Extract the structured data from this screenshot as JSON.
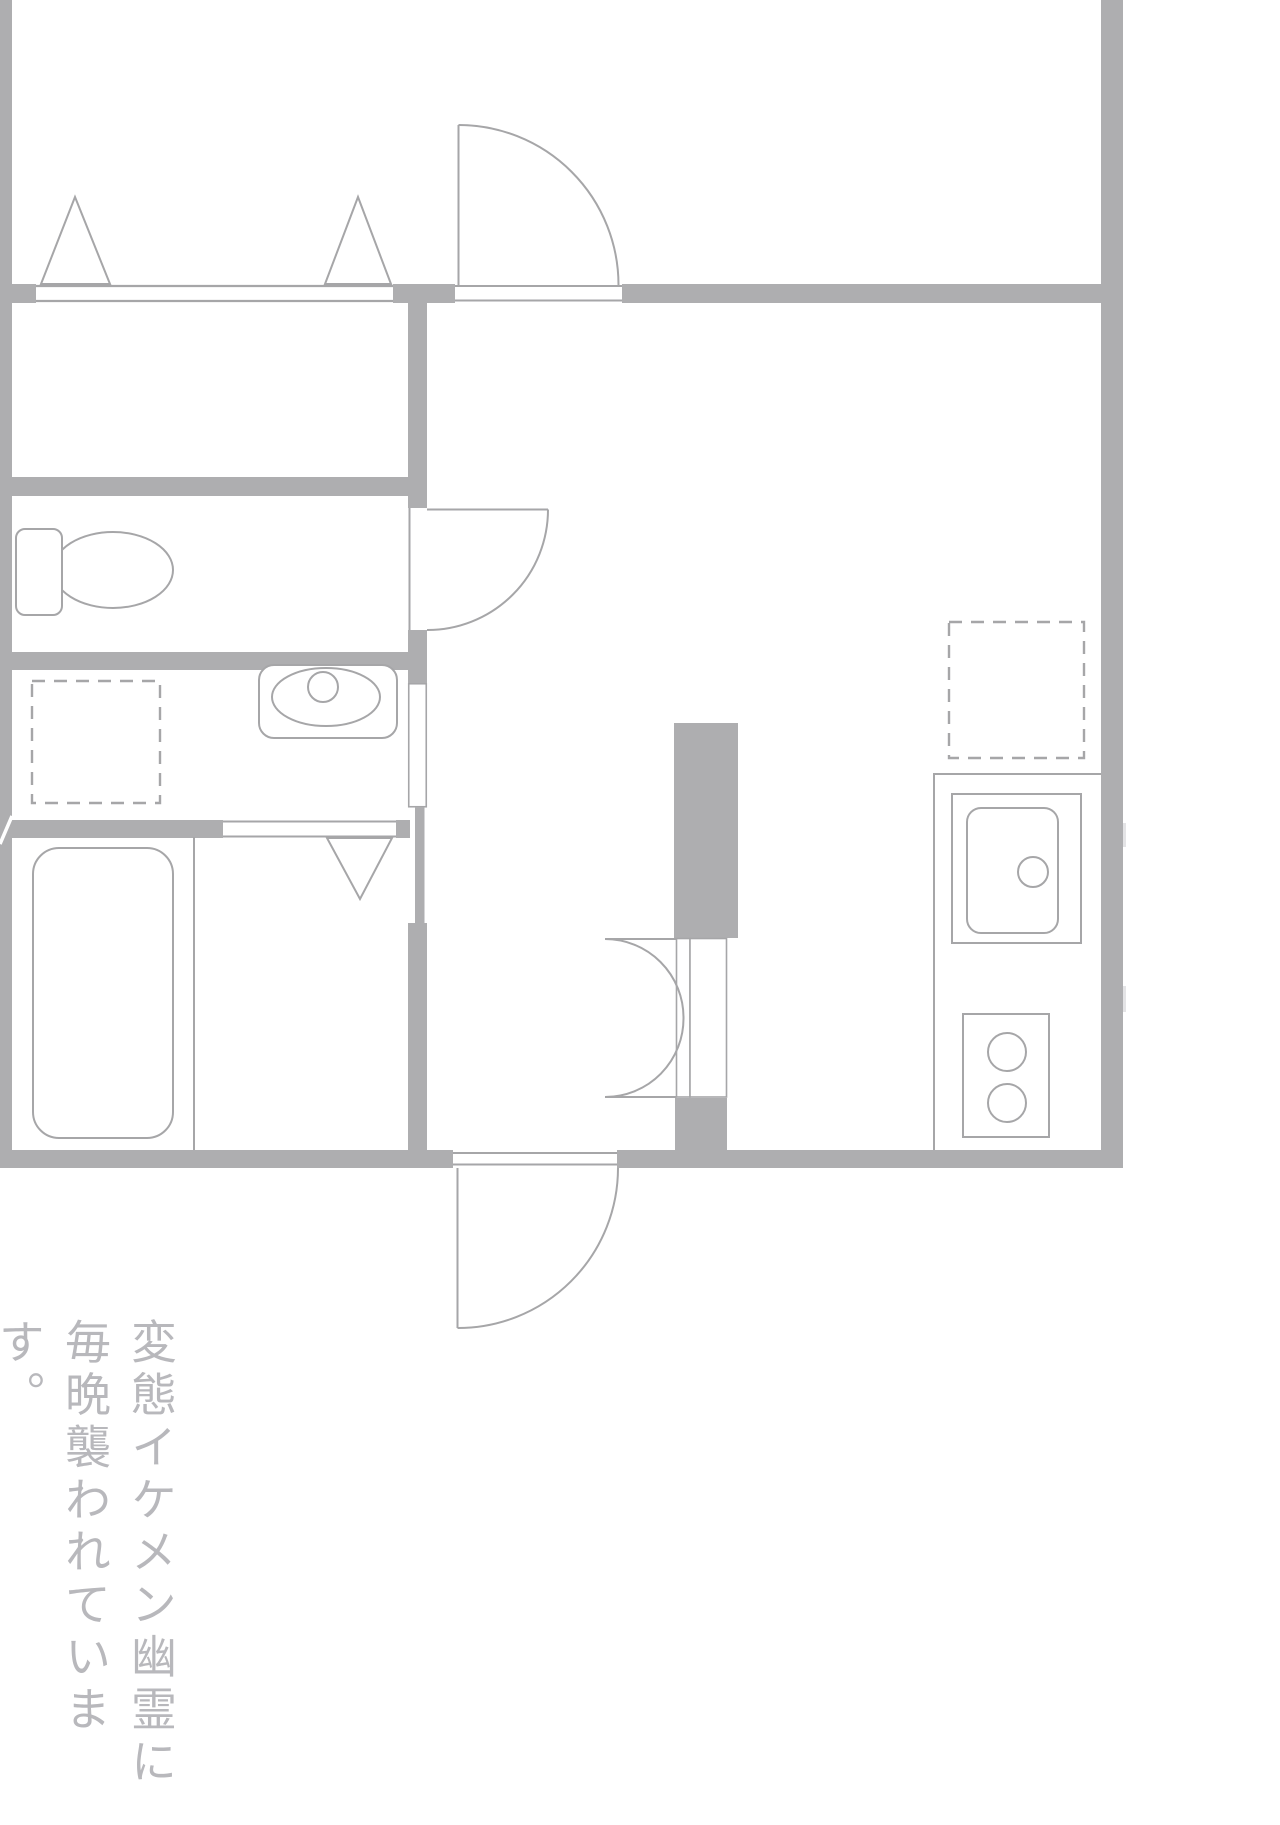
{
  "colors": {
    "background": "#ffffff",
    "wall": "#aeaeb0",
    "line": "#a6a6a8",
    "caption": "#b8b8bc",
    "faint": "#e4e4e6"
  },
  "caption": {
    "column1": "変態イケメン幽霊に",
    "column2": "毎晩襲われています。"
  },
  "icons": {
    "closet_doors": "folding-closet-doors-icon",
    "bedroom_door": "hinged-door-icon",
    "toilet": "toilet-icon",
    "toilet_door": "hinged-door-icon",
    "washbasin": "washbasin-icon",
    "washer_space": "washing-machine-space-dashed-icon",
    "washroom_door": "sliding-door-icon",
    "bath_door": "folding-door-icon",
    "bathtub": "bathtub-icon",
    "fridge_space": "refrigerator-space-dashed-icon",
    "kitchen_sink": "kitchen-sink-icon",
    "stove": "two-burner-stove-icon",
    "double_door": "double-swing-door-icon",
    "entrance_door": "hinged-door-icon"
  }
}
